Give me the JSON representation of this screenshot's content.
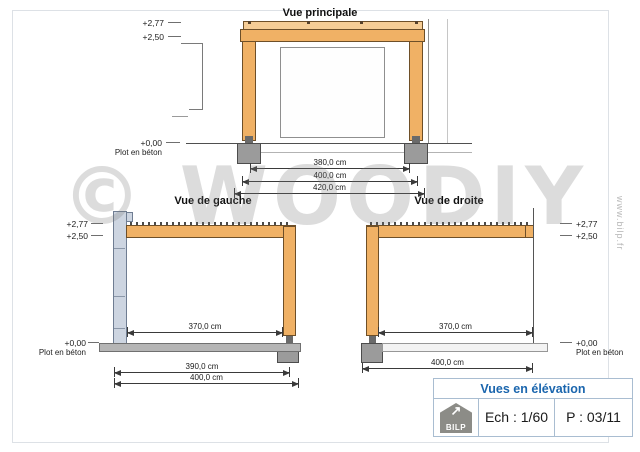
{
  "drawing": {
    "watermark": "© WOODIY",
    "website": "www.bilp.fr",
    "views": {
      "main": {
        "title": "Vue principale",
        "level_top": "+2,77",
        "level_mid": "+2,50",
        "level_ground": "+0,00",
        "ground_note": "Plot en béton",
        "dims": {
          "inner": "380,0 cm",
          "mid": "400,0 cm",
          "outer": "420,0 cm"
        }
      },
      "left": {
        "title": "Vue de gauche",
        "level_top": "+2,77",
        "level_mid": "+2,50",
        "level_ground": "+0,00",
        "ground_note": "Plot en béton",
        "dims": {
          "inner": "370,0 cm",
          "mid": "390,0 cm",
          "outer": "400,0 cm"
        }
      },
      "right": {
        "title": "Vue de droite",
        "level_top": "+2,77",
        "level_mid": "+2,50",
        "level_ground": "+0,00",
        "ground_note": "Plot en béton",
        "dims": {
          "inner": "370,0 cm",
          "outer": "400,0 cm"
        }
      }
    },
    "title_block": {
      "title": "Vues en élévation",
      "scale": "Ech : 1/60",
      "page": "P : 03/11",
      "logo_text": "BILP",
      "logo_icon": "↗"
    },
    "colors": {
      "wood": "#f0b165",
      "wood_light": "#f6cd96",
      "concrete": "#9b9b9b",
      "slab": "#b5b5b5",
      "wall": "#cdd5e1",
      "accent_blue": "#1b66ae",
      "line": "#3a3a3a"
    }
  }
}
